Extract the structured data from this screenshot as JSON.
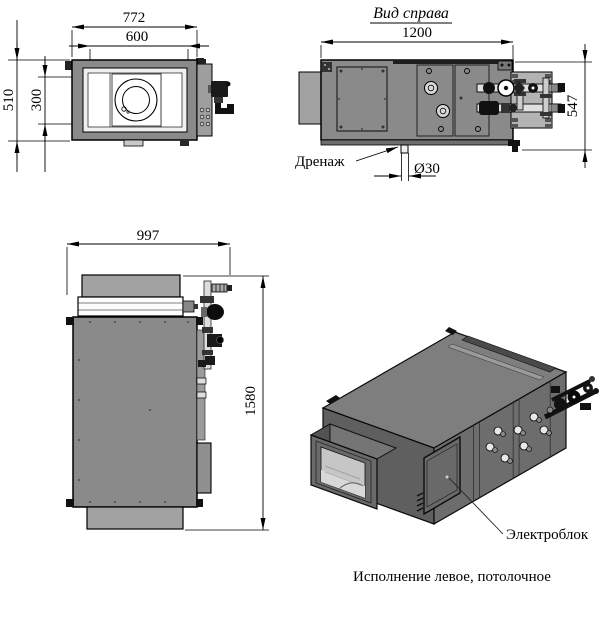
{
  "caption": "Исполнение левое, потолочное",
  "colors": {
    "body": "#8a8a8a",
    "flange": "#a2a2a2",
    "panel_light": "#f0f0f0",
    "plate": "#b3b3b3",
    "iso_top": "#7e7e7e",
    "iso_end": "#5f5f5f",
    "iso_side": "#6d6d6d"
  },
  "top_view": {
    "width_total": "772",
    "width_duct": "600",
    "depth_total": "510",
    "depth_duct": "300"
  },
  "right_view": {
    "title": "Вид справа",
    "length": "1200",
    "height": "547",
    "drain_label": "Дренаж",
    "drain_diameter": "Ø30"
  },
  "side_view": {
    "width": "997",
    "height": "1580"
  },
  "iso_view": {
    "electric_box_label": "Электроблок"
  }
}
